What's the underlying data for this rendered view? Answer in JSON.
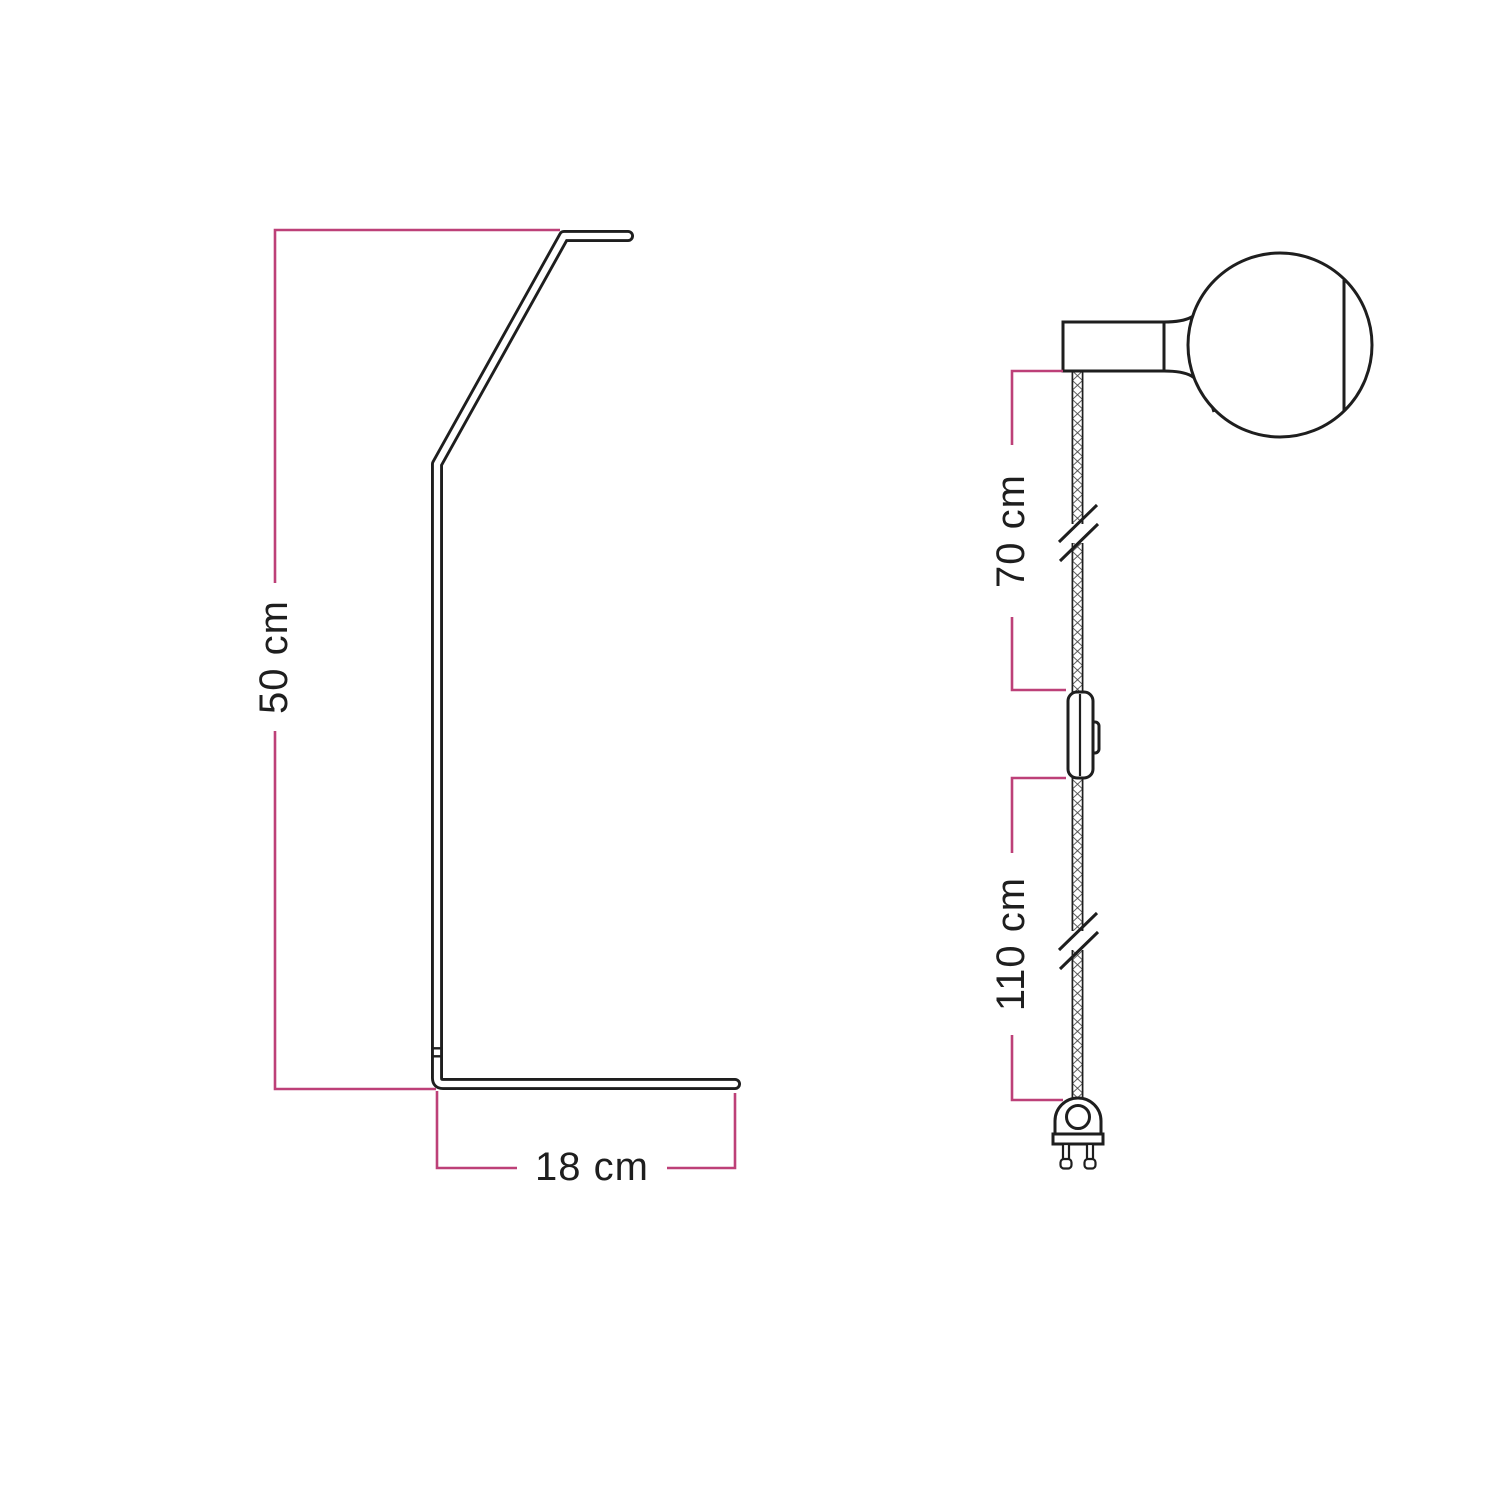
{
  "diagram": {
    "background": "#ffffff",
    "line_color": "#1e1e1e",
    "dimension_color": "#bd4078",
    "stand_view": {
      "description": "table lamp stand side profile",
      "height_label": "50 cm",
      "depth_label": "18 cm"
    },
    "cable_view": {
      "description": "textile cable with lamp holder, globe bulb, inline switch and two-pin plug",
      "socket_to_switch_label": "70 cm",
      "switch_to_plug_label": "110 cm"
    }
  }
}
